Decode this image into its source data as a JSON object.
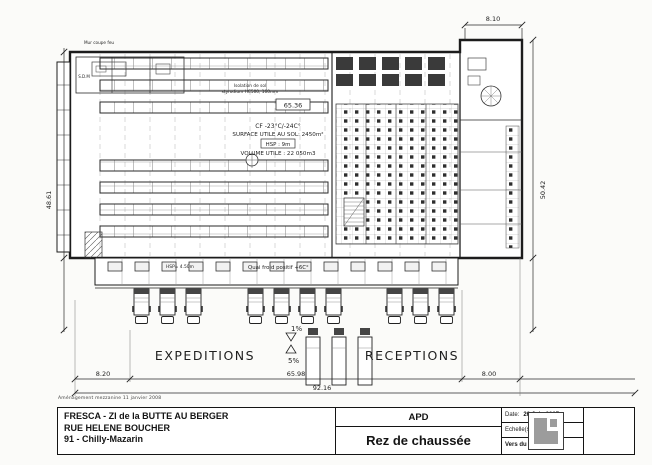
{
  "sheet": {
    "note": "Aménagement mezzanine 11 janvier 2008"
  },
  "plan": {
    "zones": {
      "expeditions": "EXPEDITIONS",
      "receptions": "RECEPTIONS"
    },
    "slopes": {
      "pct1": "1%",
      "pct5": "5%"
    },
    "cold_room": {
      "temp": "CF -23°C/-24C°",
      "surface": "SURFACE UTILE AU SOL: 2450m²",
      "height": "HSP : 9m",
      "volume": "VOLUME UTILE : 22 050m3"
    },
    "insulation_line1": "Isolation de sol",
    "insulation_line2": "styrodium HC500, 160mm",
    "quai_label": "Quai froid positif +6C°",
    "quai_height": "HSP= 4.50m",
    "firewall": "Mur coupe feu",
    "room_sdm": "S.D.M"
  },
  "dimensions": {
    "top_right": "8.10",
    "left": "48.61",
    "right": "50.42",
    "bottom_left": "8.20",
    "bottom_mid": "65.98",
    "bottom_right": "8.00",
    "bottom_total": "92.16",
    "hall_width": "65.36"
  },
  "title_block": {
    "client_lines": [
      "FRESCA - ZI de la BUTTE AU BERGER",
      "RUE HELENE BOUCHER",
      "91 - Chilly-Mazarin"
    ],
    "phase": "APD",
    "drawing_title": "Rez de chaussée",
    "date_label": "Date:",
    "date_value": "26 Juin 2007",
    "scale_label": "Echelle(s):",
    "scale_value": "1:300",
    "version": "Vers du 22 - 02 - 08"
  }
}
